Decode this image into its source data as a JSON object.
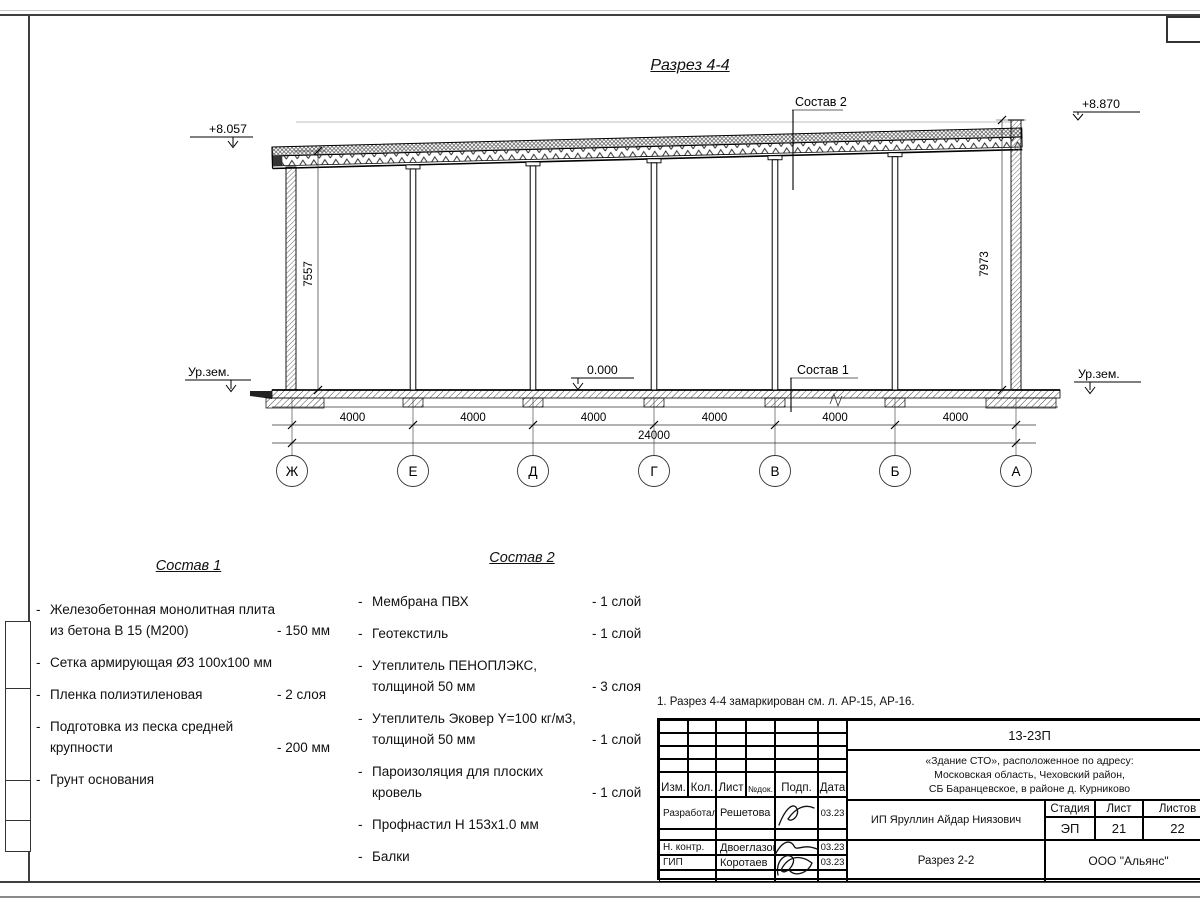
{
  "drawing": {
    "title": "Разрез 4-4",
    "axes": [
      "Ж",
      "Е",
      "Д",
      "Г",
      "В",
      "Б",
      "А"
    ],
    "bay_dims": [
      "4000",
      "4000",
      "4000",
      "4000",
      "4000",
      "4000"
    ],
    "total_dim": "24000",
    "dim_left": "7557",
    "dim_right": "7973",
    "elev_left_top": "+8.057",
    "elev_right_top": "+8.870",
    "elev_zero": "0.000",
    "ground_left": "Ур.зем.",
    "ground_right": "Ур.зем.",
    "leader_roof": "Состав 2",
    "leader_floor": "Состав 1"
  },
  "composition1": {
    "title": "Состав 1",
    "bullet": "-",
    "items": [
      {
        "lines": [
          "Железобетонная  монолитная плита",
          "из бетона В 15 (М200)"
        ],
        "value": "- 150 мм"
      },
      {
        "lines": [
          "Сетка армирующая Ø3 100х100 мм"
        ],
        "value": ""
      },
      {
        "lines": [
          "Пленка полиэтиленовая"
        ],
        "value": "-  2 слоя"
      },
      {
        "lines": [
          "Подготовка из песка средней",
          "крупности"
        ],
        "value": "- 200 мм"
      },
      {
        "lines": [
          "Грунт основания"
        ],
        "value": ""
      }
    ]
  },
  "composition2": {
    "title": "Состав 2",
    "bullet": "-",
    "items": [
      {
        "lines": [
          "Мембрана ПВХ"
        ],
        "value": "- 1 слой"
      },
      {
        "lines": [
          "Геотекстиль"
        ],
        "value": "- 1 слой"
      },
      {
        "lines": [
          "Утеплитель ПЕНОПЛЭКС,",
          "толщиной 50 мм"
        ],
        "value": "- 3 слоя"
      },
      {
        "lines": [
          "Утеплитель Эковер Y=100 кг/м3,",
          "толщиной 50 мм"
        ],
        "value": "- 1 слой"
      },
      {
        "lines": [
          "Пароизоляция для плоских кровель"
        ],
        "value": "- 1 слой"
      },
      {
        "lines": [
          "Профнастил Н 153х1.0 мм"
        ],
        "value": ""
      },
      {
        "lines": [
          "Балки"
        ],
        "value": ""
      }
    ]
  },
  "note": "1. Разрез 4-4 замаркирован см. л. АР-15, АР-16.",
  "titleblock": {
    "doc_number": "13-23П",
    "project_lines": [
      "«Здание СТО», расположенное по адресу:",
      "Московская область, Чеховский район,",
      "СБ Баранцевское, в районе д. Курниково"
    ],
    "header_cols": [
      "Изм.",
      "Кол.",
      "Лист",
      "№док.",
      "Подп.",
      "Дата"
    ],
    "rows": [
      {
        "role": "Разработал",
        "name": "Решетова",
        "date": "03.23"
      },
      {
        "role": "Н. контр.",
        "name": "Двоеглазов",
        "date": "03.23"
      },
      {
        "role": "ГИП",
        "name": "Коротаев",
        "date": "03.23"
      }
    ],
    "client": "ИП Яруллин Айдар Ниязович",
    "stage_label": "Стадия",
    "sheet_label": "Лист",
    "sheets_label": "Листов",
    "stage": "ЭП",
    "sheet": "21",
    "sheets": "22",
    "drawing_name": "Разрез 2-2",
    "company": "ООО \"Альянс\""
  }
}
